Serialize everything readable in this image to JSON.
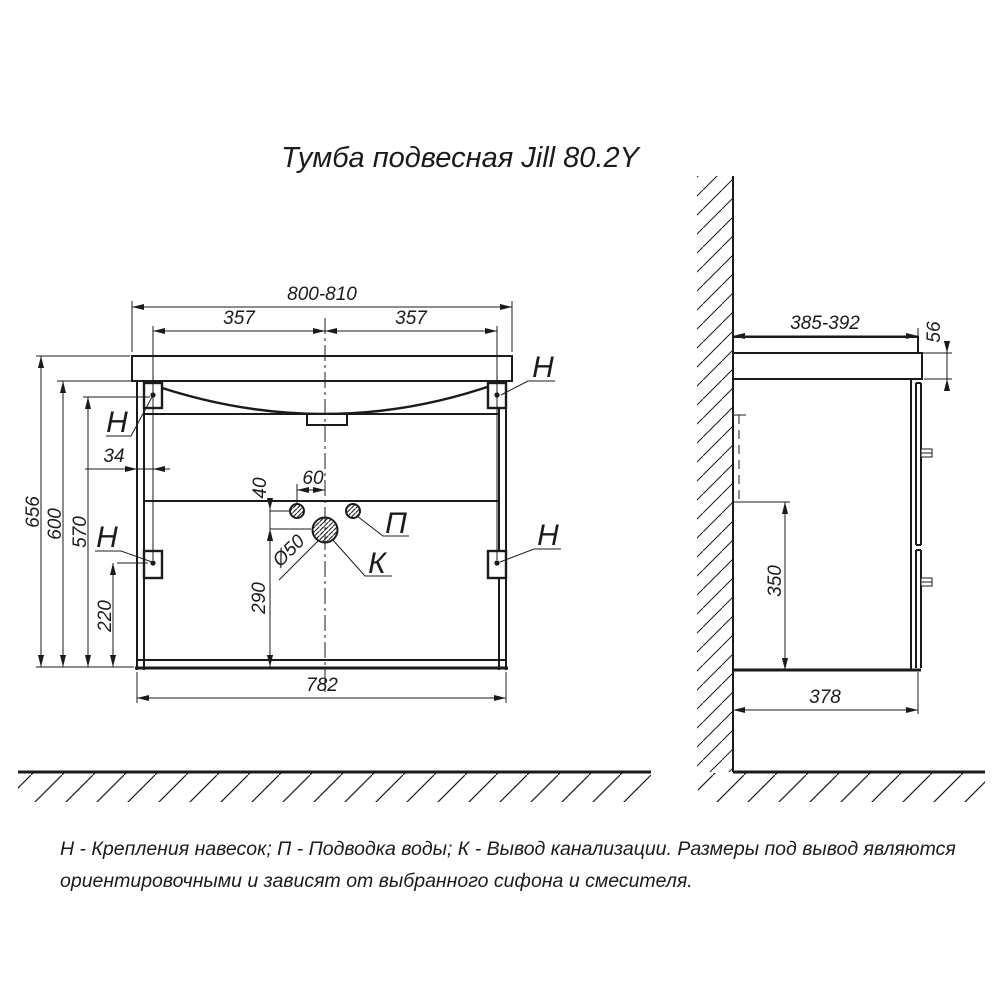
{
  "title": "Тумба подвесная Jill 80.2Y",
  "front_view": {
    "dim_width_overall": "800-810",
    "dim_mount_spacing_left": "357",
    "dim_mount_spacing_right": "357",
    "dim_mount_edge_offset": "34",
    "dim_height_overall": "656",
    "dim_height_cabinet": "600",
    "dim_height_mount": "570",
    "dim_mount_bottom": "220",
    "dim_drain_center_height": "290",
    "dim_water_vert_offset": "40",
    "dim_water_horiz_offset": "60",
    "dim_drain_diameter": "Ø50",
    "dim_body_width": "782",
    "label_mount_top_left": "Н",
    "label_mount_top_right": "Н",
    "label_mount_bottom_left": "Н",
    "label_mount_bottom_right": "Н",
    "label_water": "П",
    "label_drain": "К"
  },
  "side_view": {
    "dim_depth_overall": "385-392",
    "dim_apron_height": "56",
    "dim_niche_height": "350",
    "dim_body_depth": "378"
  },
  "legend": {
    "line1": "Н - Крепления навесок; П - Подводка воды; К - Вывод канализации. Размеры под вывод являются",
    "line2": "ориентировочными и зависят от выбранного сифона и смесителя."
  },
  "colors": {
    "line": "#1b1b1b",
    "background": "#ffffff"
  }
}
